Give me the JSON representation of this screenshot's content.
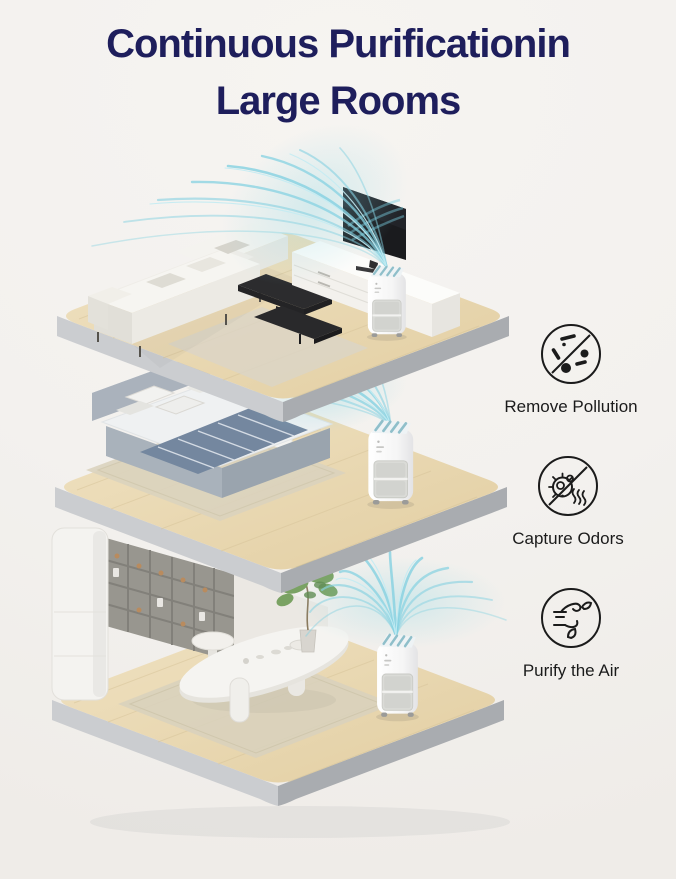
{
  "title": {
    "line1": "Continuous Purificationin",
    "line2": "Large Rooms"
  },
  "features": [
    {
      "label": "Remove Pollution",
      "icon": "no-pollution-particles-icon"
    },
    {
      "label": "Capture Odors",
      "icon": "no-odor-germ-icon"
    },
    {
      "label": "Purify the Air",
      "icon": "wind-leaves-icon"
    }
  ],
  "scene": {
    "product": "portable air purifier",
    "floors": [
      {
        "name": "living-room",
        "objects": [
          "sofa",
          "pillows",
          "coffee-table",
          "tv-console",
          "tv",
          "rug",
          "air-purifier",
          "airflow"
        ]
      },
      {
        "name": "bedroom",
        "objects": [
          "bed",
          "headboard",
          "pillows",
          "striped-blanket",
          "rug",
          "support-pillar",
          "air-purifier",
          "airflow"
        ]
      },
      {
        "name": "dining-room",
        "objects": [
          "storage-column",
          "shelf-wall",
          "dining-table",
          "stool",
          "tableware",
          "potted-plant",
          "rug",
          "air-purifier",
          "airflow"
        ]
      }
    ]
  },
  "colors": {
    "title": "#1e1e5c",
    "background": "#f3f1ee",
    "airflow": "#85d1e1",
    "wood_floor": "#ead9b4",
    "platform_edge_light": "#cbcdd0",
    "platform_edge_dark": "#a9acb0",
    "icon_stroke": "#1b1b1b",
    "label_text": "#1b1b1b"
  }
}
